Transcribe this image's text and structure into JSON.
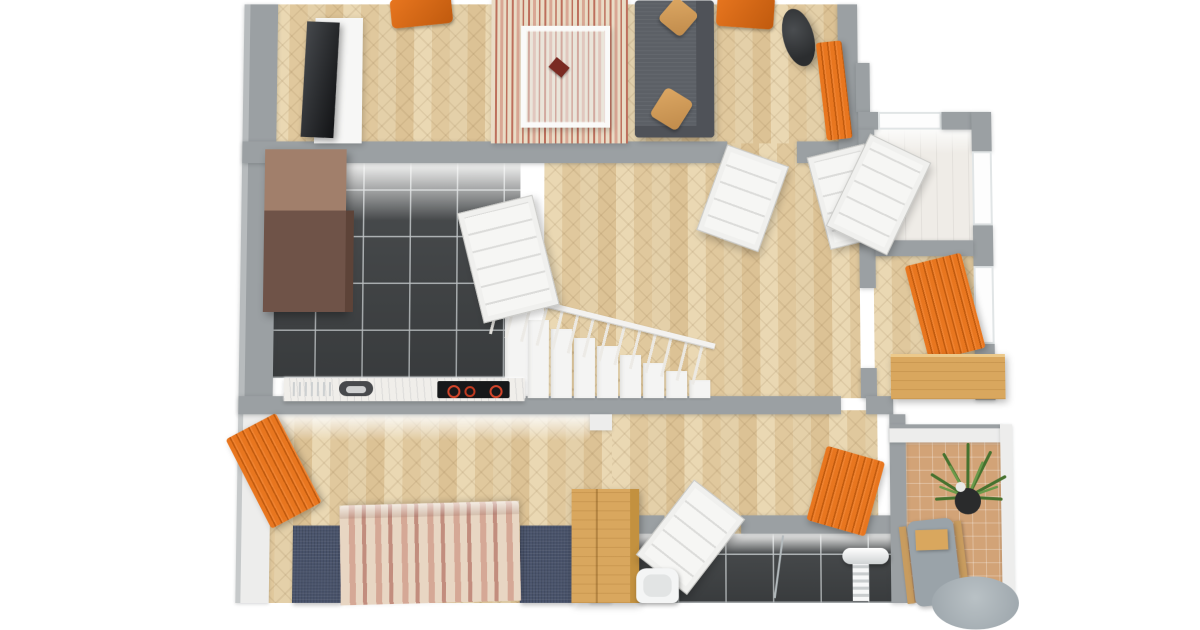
{
  "scene": {
    "description": "3D rendered residential floor plan, top-down bird's-eye view, cropped at top and bottom",
    "style": "photoreal architectural render on white background",
    "visible_text": []
  },
  "colors": {
    "bg": "#ffffff",
    "wall": "#9ba0a3",
    "wall-light": "#b7bbbd",
    "wall-face": "#ededec",
    "wood-base": "#e4d0a9",
    "wood-light": "#ead8b3",
    "wood-mid": "#e0c89d",
    "wood-dark": "#dcc295",
    "grain": "rgba(120,90,50,0.11)",
    "tile-dark": "#3f4244",
    "grout": "rgba(195,200,202,0.85)",
    "counter": "#f0eeea",
    "cabinet-top": "#a17f6b",
    "cabinet-front": "#6f5348",
    "sofa": "#5c6066",
    "sofa-dark": "#4f5258",
    "cushion": "#dca763",
    "cushion-dark": "#c08b4b",
    "orange": "#e8761f",
    "orange-dark": "#c05a0e",
    "rug-cream": "#e9dcc6",
    "rug-red": "#bd6f5c",
    "rug-pink": "#d9a794",
    "navy": "#49536b",
    "duvet-cream": "#e8d6c3",
    "duvet-pink": "#d5a896",
    "duvet-dark": "#c28d7e",
    "wood-furniture": "#d9a75e",
    "terracotta": "#d2a377",
    "terracotta-line": "rgba(255,255,255,0.28)",
    "plant": "#46722f",
    "plant-light": "#6b9a4a",
    "pot": "#2a2b2c",
    "chair-gray": "#9aa3a9",
    "lamp": "#2b2d2f",
    "stair": "#f4f4f3",
    "stair-shadow": "#d9d9d7",
    "door": "#f6f6f4",
    "door-line": "#dcdcda"
  },
  "rooms": [
    {
      "name": "living-room",
      "position": "top-left",
      "floor": "herringbone-parquet",
      "furniture": [
        "wall-tv",
        "tv-board",
        "orange-armchair",
        "striped-rug",
        "glass-coffee-table",
        "book",
        "gray-sofa",
        "two-tan-cushions",
        "black-floor-lamp",
        "orange-armchair-2",
        "orange-radiator",
        "double-doors"
      ]
    },
    {
      "name": "kitchen",
      "position": "middle-left",
      "floor": "dark-tile",
      "furniture": [
        "tall-brown-cabinet",
        "countertop",
        "sink",
        "cooktop-with-red-burners",
        "open-door"
      ]
    },
    {
      "name": "hallway",
      "position": "center",
      "floor": "herringbone-parquet",
      "furniture": [
        "staircase-with-railing",
        "orange-radiator"
      ]
    },
    {
      "name": "storage-room",
      "position": "top-right",
      "floor": "light-plank",
      "furniture": [
        "open-door",
        "window"
      ]
    },
    {
      "name": "study-nook",
      "position": "middle-right",
      "floor": "herringbone-parquet",
      "furniture": [
        "orange-radiator",
        "wooden-desk",
        "window"
      ]
    },
    {
      "name": "bedroom",
      "position": "bottom-left",
      "floor": "herringbone-parquet",
      "furniture": [
        "orange-radiator",
        "double-bed-striped-duvet",
        "navy-bedside-rug-left",
        "navy-bedside-rug-right",
        "wooden-wardrobe"
      ]
    },
    {
      "name": "bathroom",
      "position": "bottom-center",
      "floor": "dark-tile",
      "furniture": [
        "toilet",
        "shower-towel-rail",
        "glass-screen",
        "open-door"
      ]
    },
    {
      "name": "sunroom",
      "position": "bottom-right",
      "floor": "terracotta-tile",
      "furniture": [
        "potted-plant",
        "gray-lounge-chair",
        "round-gray-rug"
      ]
    }
  ]
}
